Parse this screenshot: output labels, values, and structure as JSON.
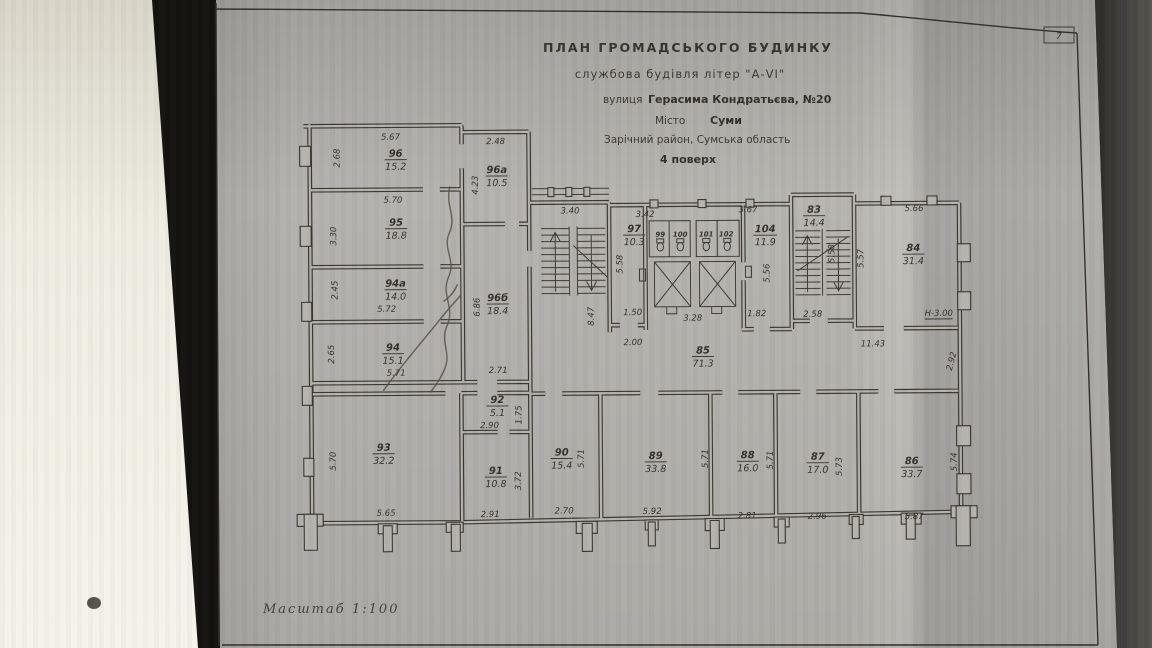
{
  "page": {
    "tab_number": "7"
  },
  "title_block": {
    "line1": "ПЛАН  ГРОМАДСЬКОГО  БУДИНКУ",
    "line2": "службова будівля літер \"А-VI\"",
    "street_label": "вулиця",
    "street_value": "Герасима Кондратьєва, №20",
    "city_label": "Місто",
    "city_value": "Суми",
    "district": "Зарічний район, Сумська область",
    "floor": "4 поверх"
  },
  "scale": {
    "label": "Масштаб",
    "value": "1:100"
  },
  "rooms": [
    {
      "id": "96",
      "area": "15.2"
    },
    {
      "id": "96а",
      "area": "10.5"
    },
    {
      "id": "95",
      "area": "18.8"
    },
    {
      "id": "94а",
      "area": "14.0"
    },
    {
      "id": "96б",
      "area": "18.4"
    },
    {
      "id": "94",
      "area": "15.1"
    },
    {
      "id": "97",
      "area": "10.3"
    },
    {
      "id": "104",
      "area": "11.9"
    },
    {
      "id": "83",
      "area": "14.4"
    },
    {
      "id": "84",
      "area": "31.4"
    },
    {
      "id": "85",
      "area": "71.3"
    },
    {
      "id": "92",
      "area": "5.1"
    },
    {
      "id": "93",
      "area": "32.2"
    },
    {
      "id": "91",
      "area": "10.8"
    },
    {
      "id": "90",
      "area": "15.4"
    },
    {
      "id": "89",
      "area": "33.8"
    },
    {
      "id": "88",
      "area": "16.0"
    },
    {
      "id": "87",
      "area": "17.0"
    },
    {
      "id": "86",
      "area": "33.7"
    },
    {
      "id": "99",
      "area": ""
    },
    {
      "id": "100",
      "area": ""
    },
    {
      "id": "101",
      "area": ""
    },
    {
      "id": "102",
      "area": ""
    }
  ],
  "dims": [
    "5.67",
    "2.68",
    "2.48",
    "4.23",
    "5.70",
    "3.30",
    "2.45",
    "5.72",
    "2.65",
    "5.71",
    "6.86",
    "3.40",
    "8.47",
    "3.42",
    "5.58",
    "1.50",
    "2.00",
    "3.67",
    "5.56",
    "3.28",
    "1.82",
    "5.58",
    "2.58",
    "5.66",
    "5.57",
    "11.43",
    "2.92",
    "2.71",
    "1.75",
    "2.90",
    "5.70",
    "5.65",
    "2.91",
    "3.72",
    "2.70",
    "5.71",
    "5.92",
    "5.71",
    "5.71",
    "2.81",
    "5.73",
    "2.96",
    "5.87",
    "5.74",
    "Н-3.00"
  ]
}
